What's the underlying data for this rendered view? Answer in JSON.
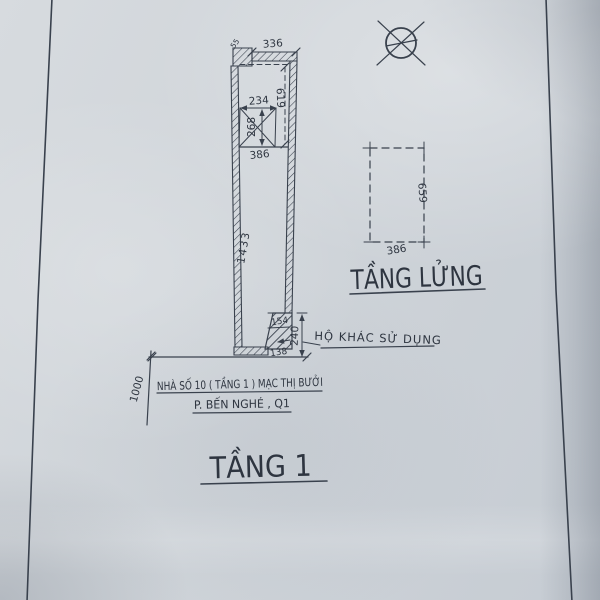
{
  "floor1": {
    "label": "TẦNG 1",
    "note_other_household": "HỘ KHÁC SỬ DỤNG",
    "address_line1": "NHÀ SỐ 10 ( TẦNG 1 ) MẠC THỊ BƯỞI",
    "address_line2": "P. BẾN NGHÉ , Q1",
    "dims": {
      "front_width": "336",
      "front_notch": "55",
      "upper_room_depth": "619",
      "stair_width": "234",
      "stair_depth": "268",
      "inner_width": "386",
      "total_length": "1433",
      "rear_top_width": "154",
      "rear_bottom_width": "138",
      "rear_depth": "240",
      "front_offset": "1000"
    }
  },
  "mezzanine": {
    "label": "TẦNG LỬNG",
    "dims": {
      "width": "386",
      "depth": "659"
    }
  },
  "symbols": {
    "north": "crossed-circle"
  },
  "colors": {
    "ink": "#39414d",
    "paper": "#ced4da"
  }
}
